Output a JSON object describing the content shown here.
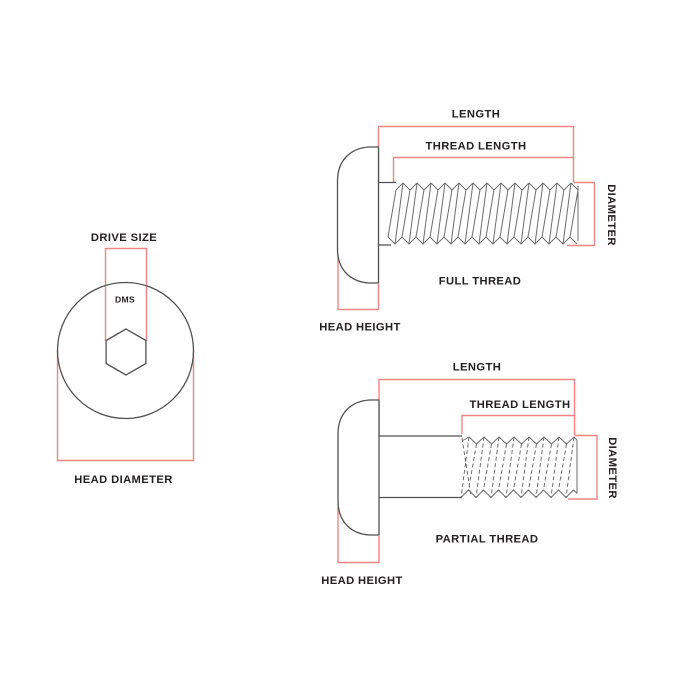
{
  "colors": {
    "annotation_red": "#f08585",
    "outline_gray": "#525254",
    "thread_gray": "#6e6e70",
    "text_dark": "#232021",
    "background": "#ffffff"
  },
  "figures": {
    "head_top_view": {
      "drive_size_label": "DRIVE SIZE",
      "drive_size_abbrev": "DMS",
      "head_diameter_label": "HEAD DIAMETER"
    },
    "full_thread_screw": {
      "length_label": "LENGTH",
      "thread_length_label": "THREAD LENGTH",
      "diameter_label": "DIAMETER",
      "thread_type_label": "FULL THREAD",
      "head_height_label": "HEAD HEIGHT"
    },
    "partial_thread_screw": {
      "length_label": "LENGTH",
      "thread_length_label": "THREAD LENGTH",
      "diameter_label": "DIAMETER",
      "thread_type_label": "PARTIAL THREAD",
      "head_height_label": "HEAD HEIGHT"
    }
  }
}
